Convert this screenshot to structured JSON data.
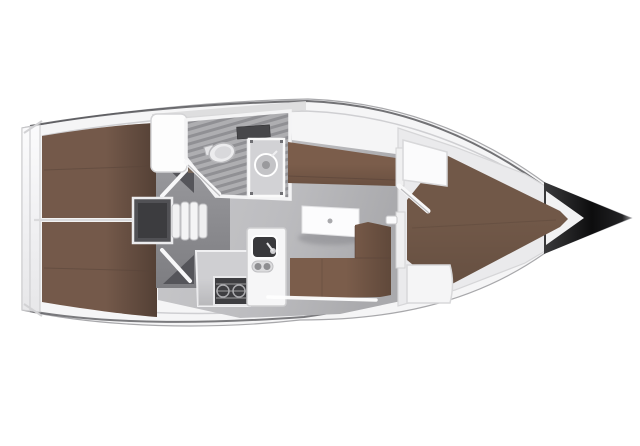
{
  "palette": {
    "background": "#ffffff",
    "hull_white": "#f5f5f6",
    "deck_band": "#ededef",
    "toe_rail": "#46464a",
    "interior_floor": "#bfbfc2",
    "side_deck_gray": "#d9d9db",
    "vestibule_gray": "#8e8e92",
    "engine_box": "#515155",
    "door_shadow": "#55555a",
    "door_leaf": "#f8f8f9",
    "head_floor": "#aeaeb1",
    "head_grate_stripe": "#8f8f93",
    "wall_white": "#f4f4f5",
    "berth_brown": "#74594a",
    "settee_brown": "#7b5d4b",
    "forward_berth_brown": "#715848",
    "seam_brown": "#5a453a",
    "table_white": "#fcfcfd",
    "galley_counter": "#cfcfd2",
    "galley_unit_white": "#f6f6f7",
    "stove_dark": "#3e3e41",
    "sink_dark": "#39393c",
    "knob_gray": "#8e8e91",
    "mirror_slot": "#47474a",
    "bow_black": "#131314",
    "fixture_white": "#ececee",
    "hatch_white": "#fdfdfd",
    "wardrobe_white": "#fbfbfc",
    "locker_brown": "#77675b",
    "shell_white": "#eaeaec"
  },
  "regions": {
    "hull": "yacht hull, bow to the right",
    "transom": "stern transom platform",
    "aft_cabins": "two aft double berths",
    "companionway": "entry steps with engine compartment",
    "head": "bathroom with toilet, washbasin and grate floor",
    "saloon": "table with L-shaped and straight settees",
    "galley": "counter, gimballed stove and sink unit",
    "forward_cabin": "V-berth, wardrobe and seat",
    "bow_tip": "black anchor/bow fitting"
  }
}
